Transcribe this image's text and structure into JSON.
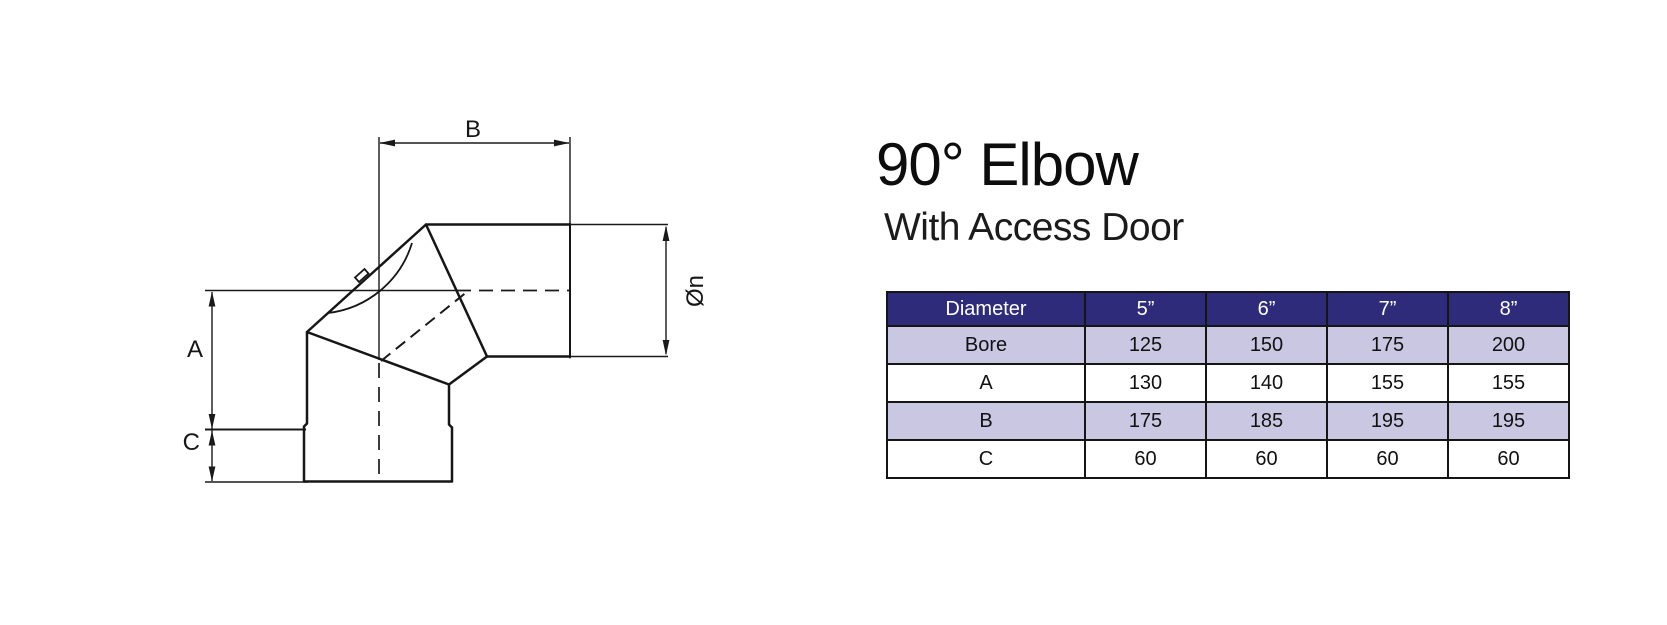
{
  "product": {
    "title": "90° Elbow",
    "subtitle": "With Access Door"
  },
  "diagram": {
    "labels": {
      "a": "A",
      "b": "B",
      "c": "C",
      "diameter": "Øn"
    }
  },
  "table": {
    "colors": {
      "header_bg": "#2e2b7a",
      "header_text": "#ffffff",
      "shaded_row_bg": "#c9c7e2",
      "plain_row_bg": "#ffffff",
      "border": "#151515"
    },
    "columns": [
      "Diameter",
      "5”",
      "6”",
      "7”",
      "8”"
    ],
    "rows": [
      {
        "label": "Bore",
        "values": [
          "125",
          "150",
          "175",
          "200"
        ]
      },
      {
        "label": "A",
        "values": [
          "130",
          "140",
          "155",
          "155"
        ]
      },
      {
        "label": "B",
        "values": [
          "175",
          "185",
          "195",
          "195"
        ]
      },
      {
        "label": "C",
        "values": [
          "60",
          "60",
          "60",
          "60"
        ]
      }
    ]
  }
}
